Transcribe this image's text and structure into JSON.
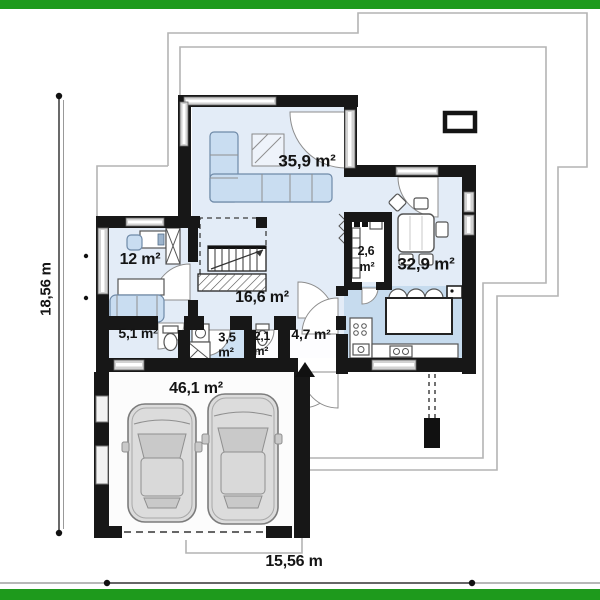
{
  "colors": {
    "green": "#1e9a1c",
    "wall": "#171717",
    "floor": "#e3ecf7",
    "kfloor": "#c6dbee",
    "bathfloor": "#cfe2f4",
    "furn": "#c9ddf1",
    "furnStroke": "#6f8aa8",
    "outline": "#b4b4b4",
    "ink": "#141414"
  },
  "rooms": {
    "living": "35,9 m²",
    "dining": "32,9 m²",
    "office": "12 m²",
    "hall": "16,6 m²",
    "laundry": "5,1 m²",
    "bath_line1": "3,5",
    "bath_line2": "m²",
    "wc_line1": "2,1",
    "wc_line2": "m²",
    "pantry_line1": "2,6",
    "pantry_line2": "m²",
    "entry": "4,7 m²",
    "garage": "46,1 m²"
  },
  "dimensions": {
    "left": "18,56 m",
    "bottom": "15,56 m"
  }
}
